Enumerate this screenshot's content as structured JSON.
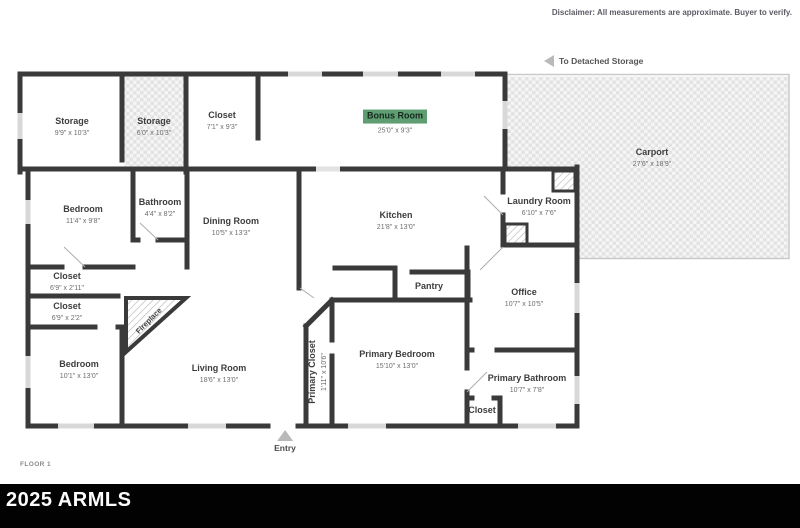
{
  "header": {
    "disclaimer": "Disclaimer: All measurements are approximate. Buyer to verify."
  },
  "annotations": {
    "to_detached_storage": "To Detached Storage",
    "entry": "Entry",
    "floor": "FLOOR 1",
    "watermark": "2025 ARMLS"
  },
  "colors": {
    "wall": "#3a3a3a",
    "window": "#d8d8d8",
    "highlight": "#5f9e72",
    "label": "#3d3d3d",
    "dims": "#6d6d6d",
    "bar": "#020202"
  },
  "rooms": [
    {
      "name": "Storage",
      "dims": "9'9\" x 10'3\""
    },
    {
      "name": "Storage",
      "dims": "6'0\" x 10'3\""
    },
    {
      "name": "Closet",
      "dims": "7'1\" x 9'3\""
    },
    {
      "name": "Bonus Room",
      "dims": "25'0\" x 9'3\""
    },
    {
      "name": "Carport",
      "dims": "27'6\" x 18'9\""
    },
    {
      "name": "Bedroom",
      "dims": "11'4\" x 9'8\""
    },
    {
      "name": "Bathroom",
      "dims": "4'4\" x 8'2\""
    },
    {
      "name": "Dining Room",
      "dims": "10'5\" x 13'3\""
    },
    {
      "name": "Kitchen",
      "dims": "21'8\" x 13'0\""
    },
    {
      "name": "Laundry Room",
      "dims": "6'10\" x 7'6\""
    },
    {
      "name": "Closet",
      "dims": "6'9\" x 2'11\""
    },
    {
      "name": "Closet",
      "dims": "6'9\" x 2'2\""
    },
    {
      "name": "Bedroom",
      "dims": "10'1\" x 13'0\""
    },
    {
      "name": "Living Room",
      "dims": "18'6\" x 13'0\""
    },
    {
      "name": "Primary Closet",
      "dims": "1'11\" x 10'6\""
    },
    {
      "name": "Primary Bedroom",
      "dims": "15'10\" x 13'0\""
    },
    {
      "name": "Pantry",
      "dims": ""
    },
    {
      "name": "Office",
      "dims": "10'7\" x 10'5\""
    },
    {
      "name": "Primary Bathroom",
      "dims": "10'7\" x 7'8\""
    },
    {
      "name": "Closet",
      "dims": ""
    },
    {
      "name": "Fireplace",
      "dims": ""
    }
  ]
}
